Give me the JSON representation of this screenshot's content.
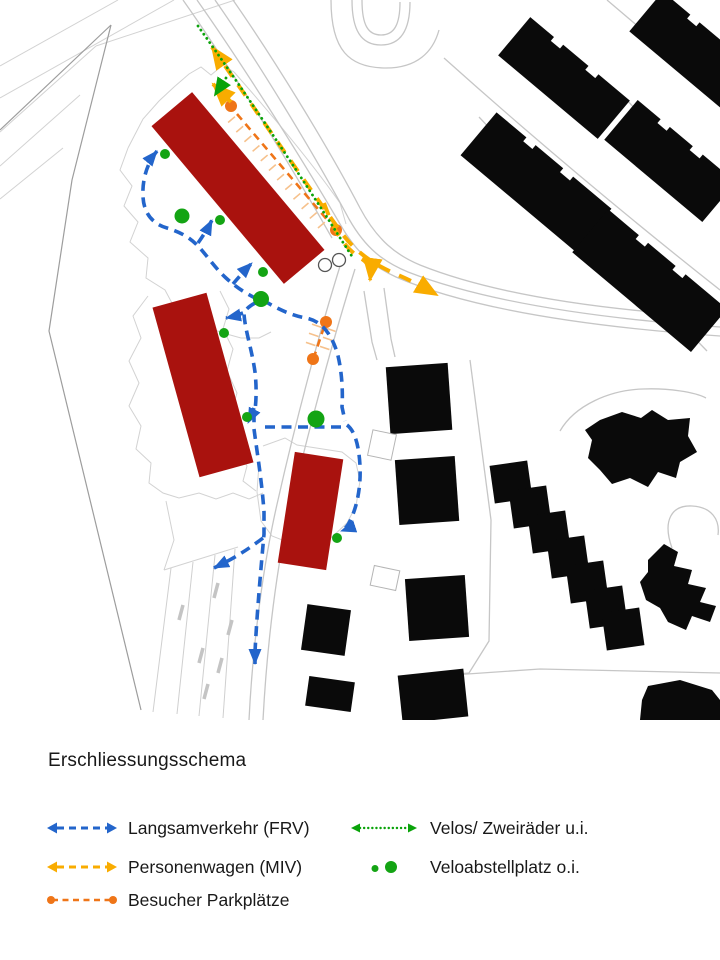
{
  "legend": {
    "title": "Erschliessungsschema",
    "items": [
      {
        "id": "frv",
        "label": "Langsamverkehr (FRV)",
        "color": "#2365cb",
        "symbol": "dashed-double-arrow"
      },
      {
        "id": "miv",
        "label": "Personenwagen (MIV)",
        "color": "#f9ac00",
        "symbol": "dashed-double-arrow"
      },
      {
        "id": "visitor-parking",
        "label": "Besucher Parkplätze",
        "color": "#ef7518",
        "symbol": "dashed-line-with-end-dots"
      },
      {
        "id": "velo",
        "label": "Velos/ Zweiräder u.i.",
        "color": "#0aa30a",
        "symbol": "dotted-double-arrow"
      },
      {
        "id": "velo-parking",
        "label": "Veloabstellplatz o.i.",
        "color": "#14a414",
        "symbol": "small-and-large-dot"
      }
    ]
  },
  "colors": {
    "frv": "#2365cb",
    "miv": "#f9ac00",
    "visitor": "#ef7518",
    "velo": "#0aa30a",
    "veloDot": "#14a414",
    "newBuilding": "#a9120e",
    "existingBuilding": "#0a0a0a",
    "road": "#c6c6c6",
    "boundary": "#9d9d9d",
    "detail": "#d2d2d2"
  }
}
